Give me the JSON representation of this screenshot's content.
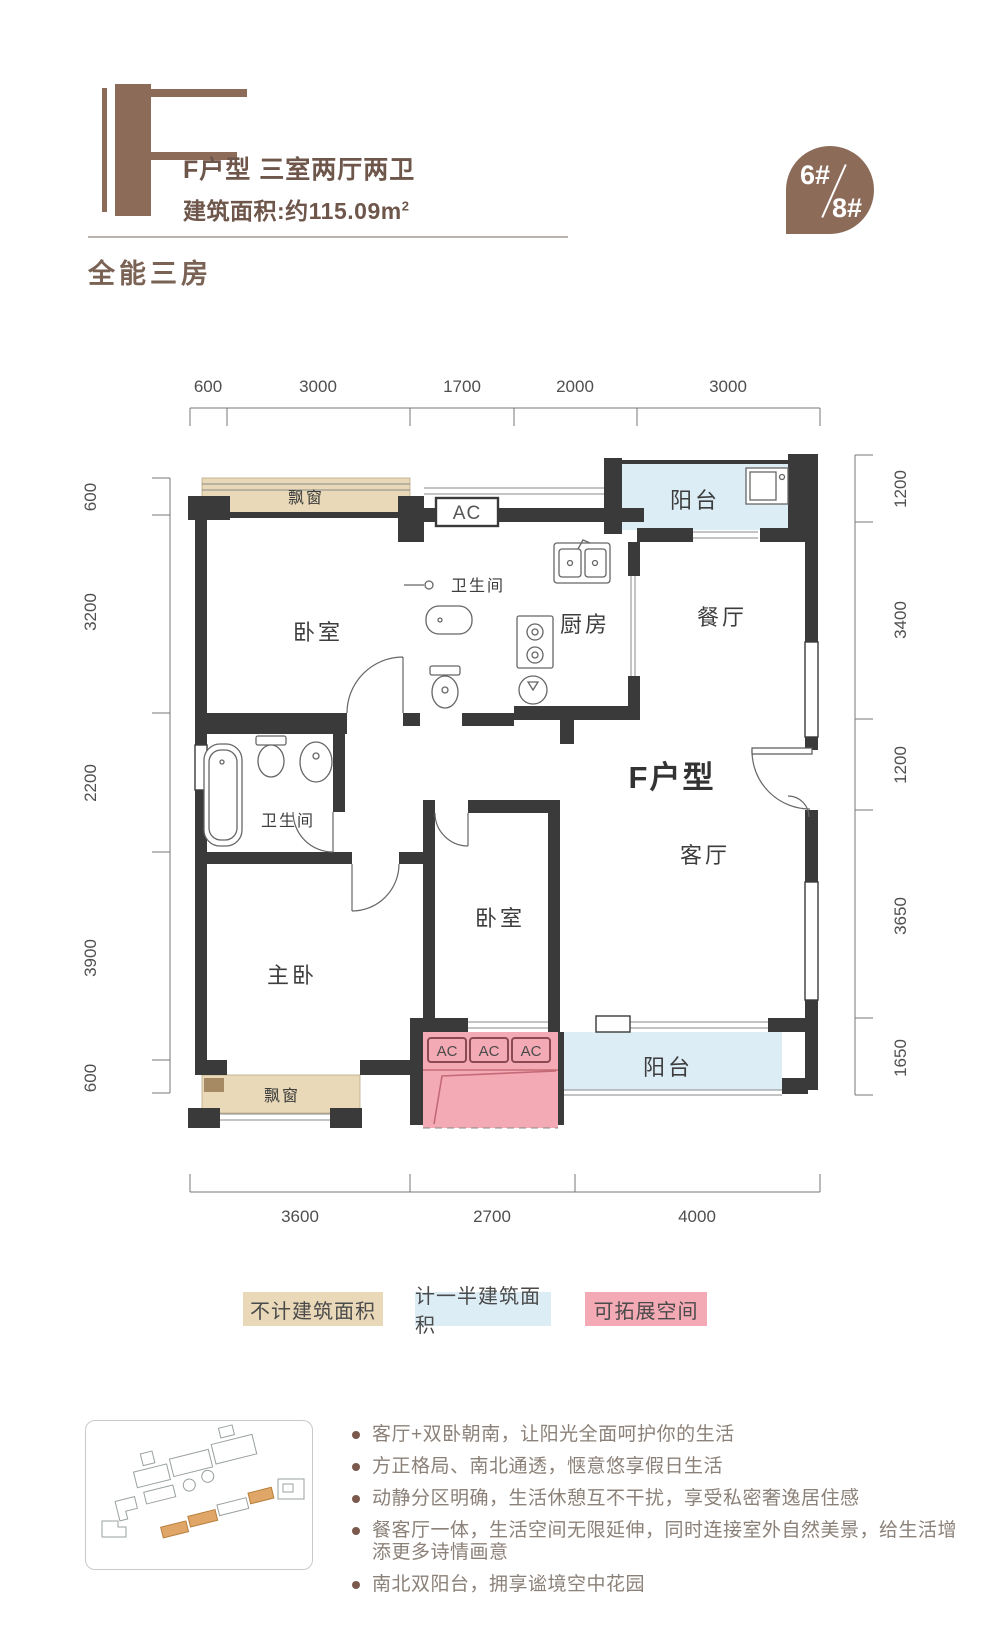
{
  "header": {
    "type_letter": "F",
    "title": "F户型 三室两厅两卫",
    "area_label": "建筑面积:约115.09m",
    "area_sup": "2",
    "badge_top": "6#",
    "badge_bottom": "8#",
    "subtitle": "全能三房"
  },
  "plan": {
    "rooms": {
      "bay_window": "飘窗",
      "bedroom": "卧室",
      "bathroom": "卫生间",
      "kitchen": "厨房",
      "dining": "餐厅",
      "balcony": "阳台",
      "living": "客厅",
      "master": "主卧",
      "unit_label": "F户型",
      "ac": "AC"
    },
    "dims_top": [
      "600",
      "3000",
      "1700",
      "2000",
      "3000"
    ],
    "dims_left": [
      "600",
      "3200",
      "2200",
      "3900",
      "600"
    ],
    "dims_right": [
      "1200",
      "3400",
      "1200",
      "3650",
      "1650"
    ],
    "dims_bottom": [
      "3600",
      "2700",
      "4000"
    ]
  },
  "legend": {
    "items": [
      {
        "label": "不计建筑面积",
        "color": "#e9d9b8"
      },
      {
        "label": "计一半建筑面积",
        "color": "#dcedf6"
      },
      {
        "label": "可拓展空间",
        "color": "#f3aab5"
      }
    ]
  },
  "features": {
    "items": [
      "客厅+双卧朝南，让阳光全面呵护你的生活",
      "方正格局、南北通透，惬意悠享假日生活",
      "动静分区明确，生活休憩互不干扰，享受私密奢逸居住感",
      "餐客厅一体，生活空间无限延伸，同时连接室外自然美景，给生活增添更多诗情画意",
      "南北双阳台，拥享谧境空中花园"
    ]
  },
  "colors": {
    "accent_brown": "#8d6b59",
    "wall": "#3a3a3a",
    "no_area_tan": "#e9d9b8",
    "half_area_blue": "#dcedf6",
    "expandable_pink": "#f3aab5"
  }
}
